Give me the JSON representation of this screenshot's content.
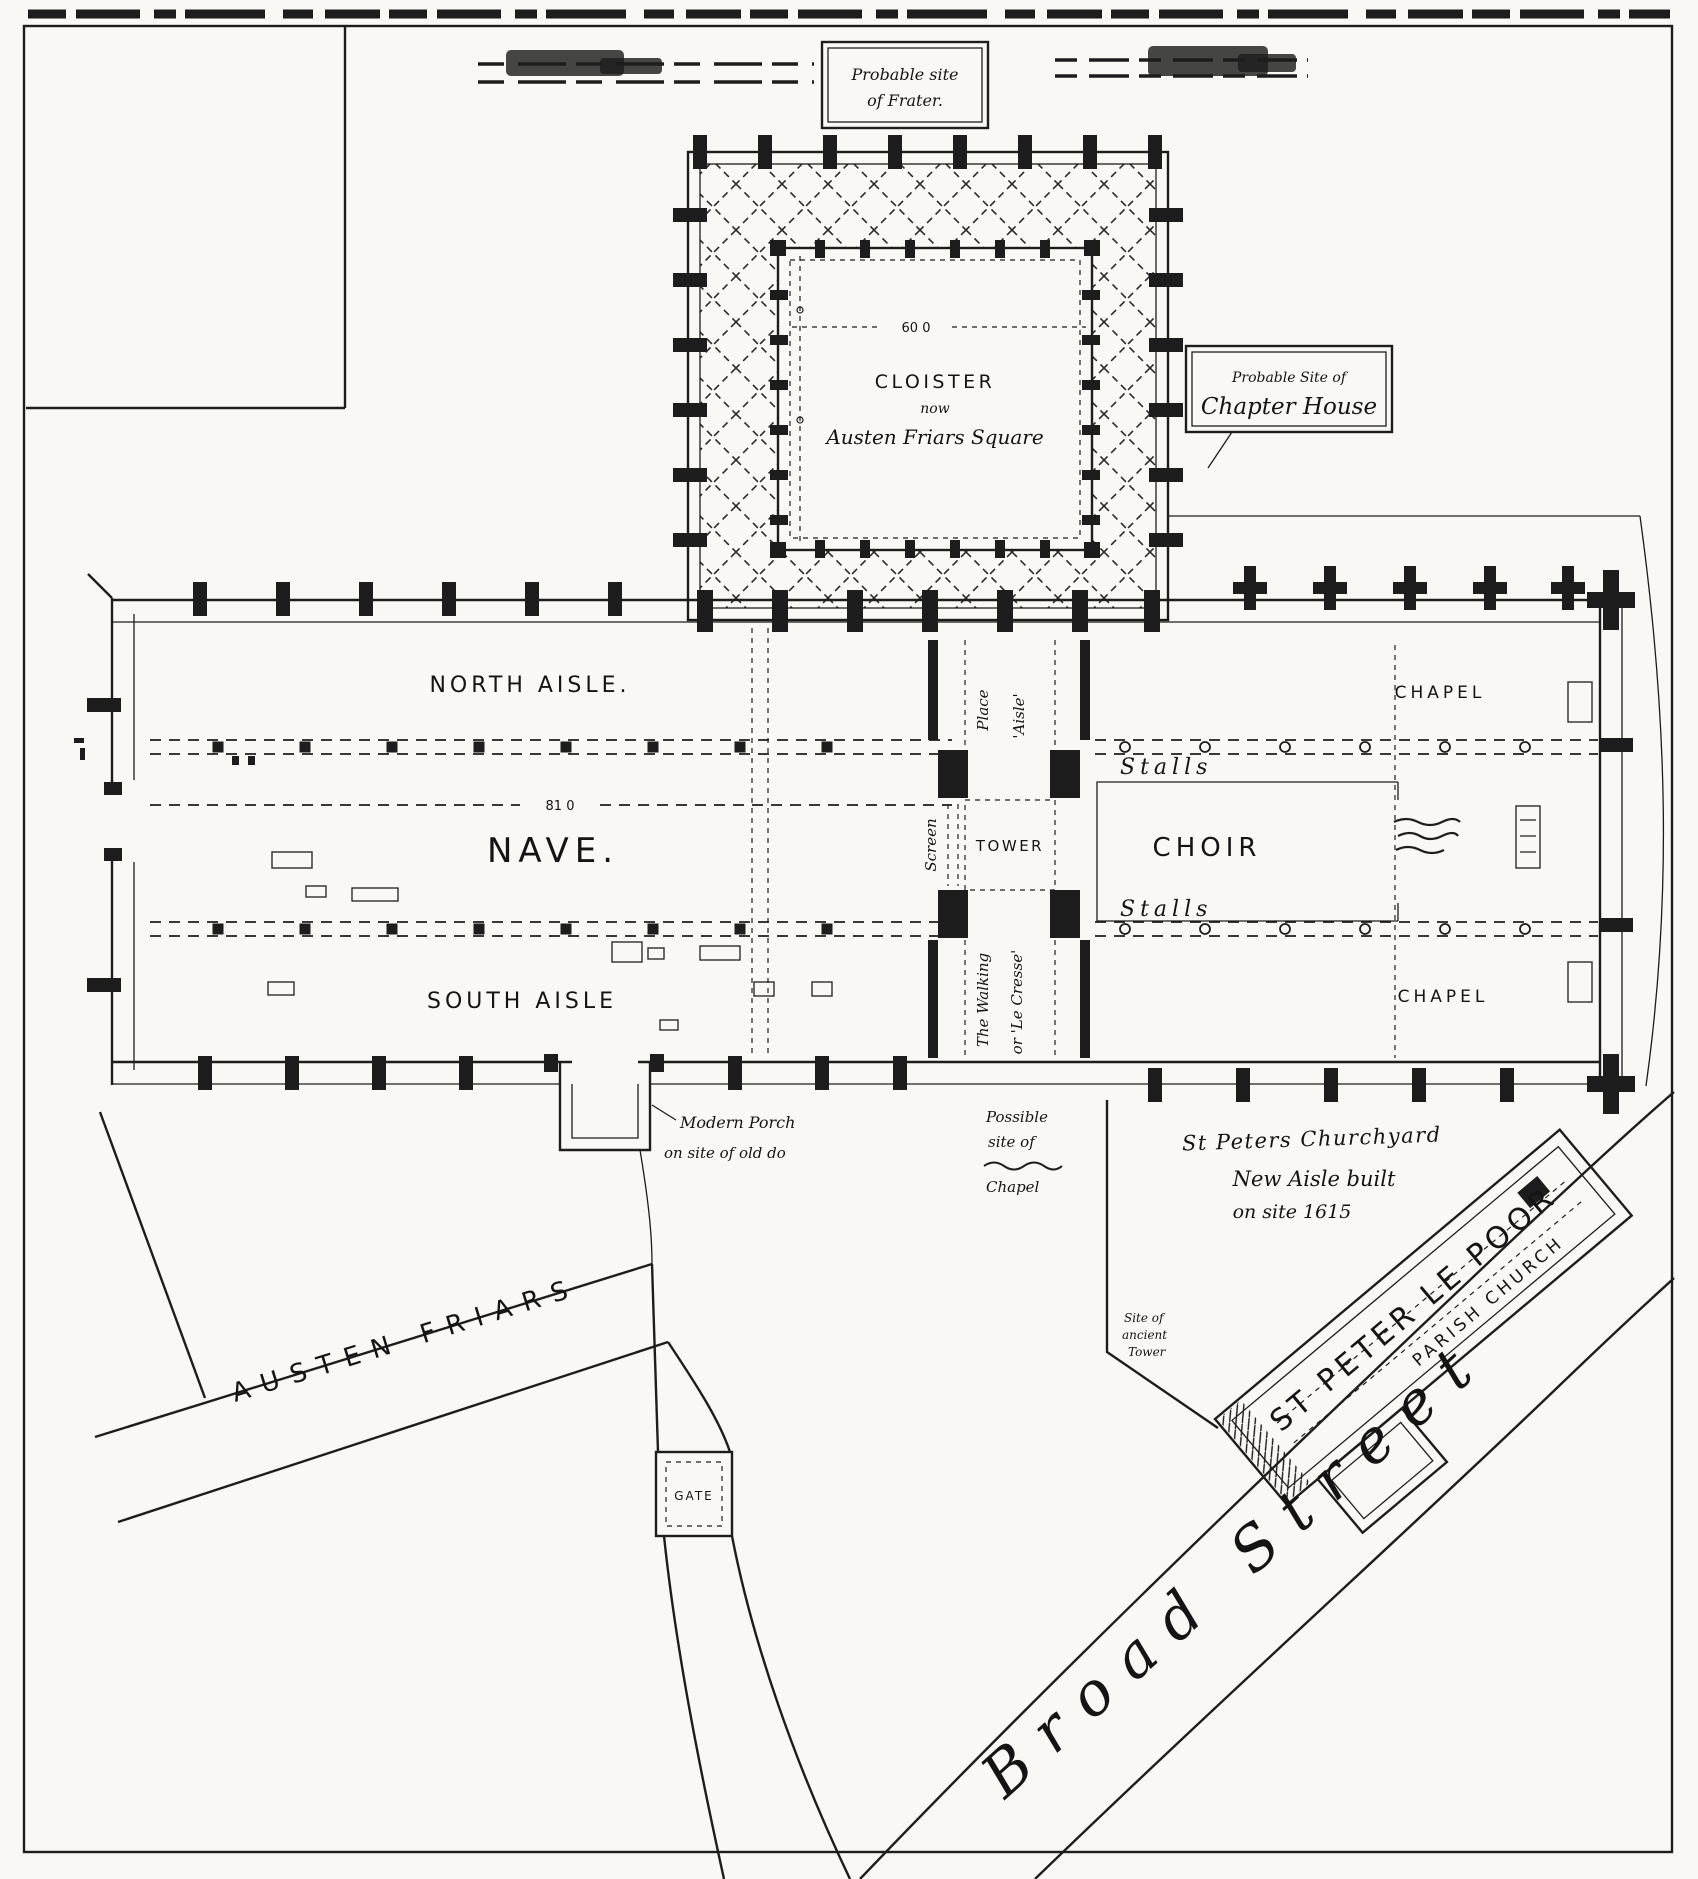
{
  "colors": {
    "ink": "#1d1d1d",
    "paper": "#f9f8f4"
  },
  "top": {
    "frater_box": {
      "line1": "Probable site",
      "line2": "of Frater."
    },
    "chapter_house_box": {
      "line1": "Probable Site of",
      "line2": "Chapter House"
    }
  },
  "cloister": {
    "title": "CLOISTER",
    "mid": "now",
    "subtitle": "Austen Friars Square",
    "dimension": "60 0"
  },
  "church": {
    "north_aisle": "NORTH AISLE.",
    "nave": "NAVE.",
    "nave_dimension": "81 0",
    "south_aisle": "SOUTH AISLE",
    "screen": "Screen",
    "tower": "TOWER",
    "place": "Place",
    "place_aisle": "'Aisle'",
    "walking_line1": "The Walking",
    "walking_line2": "or 'Le Cresse'",
    "choir": "CHOIR",
    "stalls_north": "Stalls",
    "stalls_south": "Stalls",
    "chapel_north": "CHAPEL",
    "chapel_south": "CHAPEL"
  },
  "annotations": {
    "modern_porch_line1": "Modern Porch",
    "modern_porch_line2": "on site of old do",
    "possible_chapel_line1": "Possible",
    "possible_chapel_line2": "site of",
    "possible_chapel_line3": "Chapel",
    "churchyard": "St Peters Churchyard",
    "new_aisle_line1": "New Aisle built",
    "new_aisle_line2": "on site 1615",
    "ancient_tower_line1": "Site of",
    "ancient_tower_line2": "ancient",
    "ancient_tower_line3": "Tower"
  },
  "st_peter": {
    "name": "ST PETER LE POOR",
    "type": "PARISH CHURCH"
  },
  "streets": {
    "austen_friars": "AUSTEN FRIARS",
    "broad_street": "Broad Street",
    "gate": "GATE"
  }
}
